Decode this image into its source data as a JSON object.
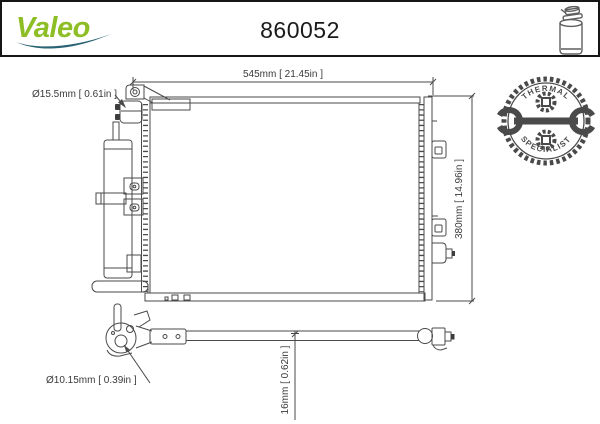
{
  "header": {
    "brand": "Valeo",
    "part_number": "860052"
  },
  "badge": {
    "arc_top": "THERMAL",
    "arc_bottom": "SPECIALIST"
  },
  "drawing": {
    "dim_width": "545mm [ 21.45in ]",
    "dim_height": "380mm [ 14.96in ]",
    "dim_inlet": "Ø15.5mm [ 0.61in ]",
    "dim_outlet": "Ø10.15mm [ 0.39in ]",
    "dim_pipe": "16mm [ 0.62in ]"
  },
  "icons": {
    "receiver_drier": "receiver-drier-icon",
    "thermal_badge": "thermal-specialist-badge",
    "wrench": "wrench-icon",
    "gear": "gear-icon"
  },
  "colors": {
    "brand_green": "#8ebe25",
    "brand_teal": "#2a6375",
    "line": "#4a4a4a",
    "badge": "#4a4a4a",
    "title": "#1a1a1a"
  }
}
